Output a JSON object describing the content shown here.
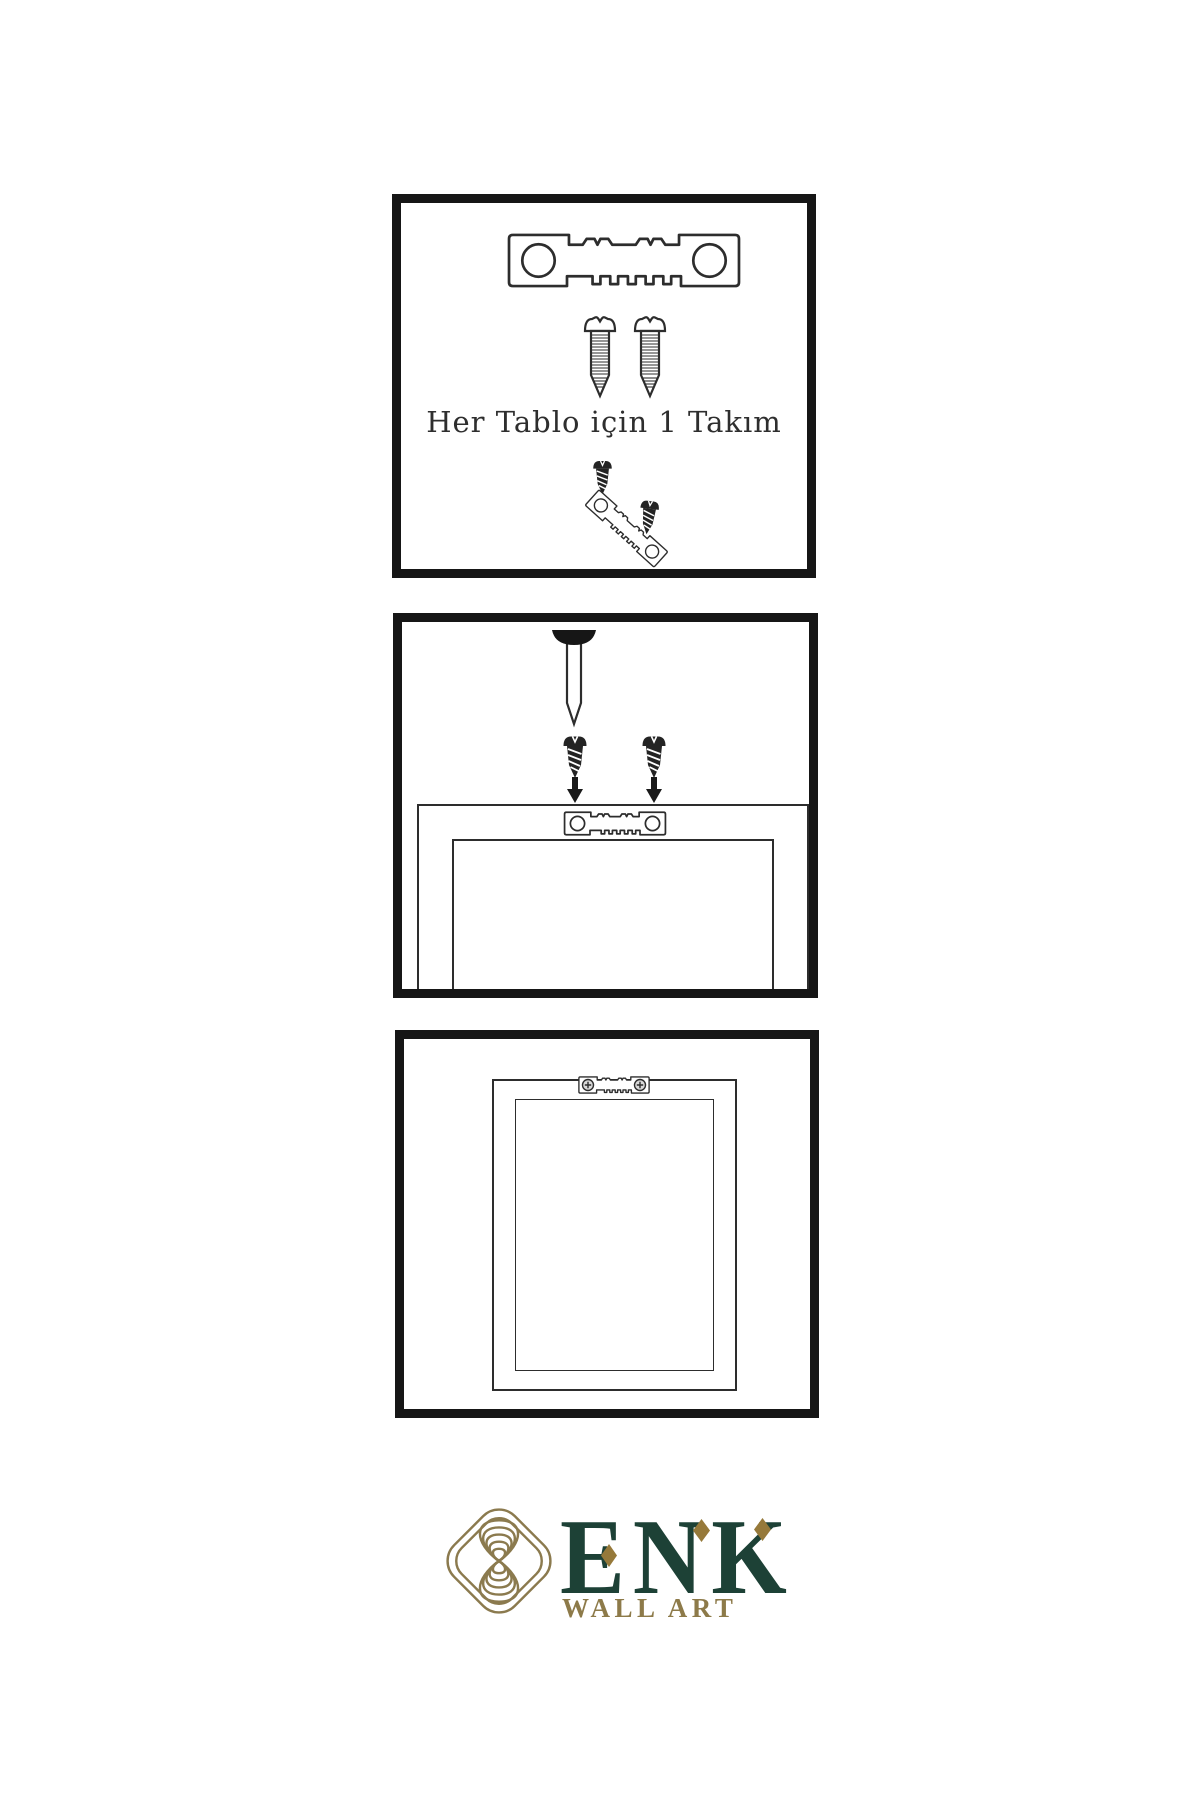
{
  "image": {
    "kind": "wall-art-hanging-instructions-infographic",
    "background": "#ffffff"
  },
  "colors": {
    "panel_border": "#161616",
    "line_art": "#2d2d2d",
    "dark_fill": "#242424",
    "brand_green": "#1d4136",
    "brand_gold": "#8d7a49",
    "diamond_gold": "#96793a",
    "icon_gold": "#8b7a4e"
  },
  "panels": [
    {
      "name": "hardware-kit",
      "caption": "Her Tablo için 1 Takım",
      "items": [
        "sawtooth-hanger-icon",
        "screw-icon",
        "screw-icon",
        "screw-icon",
        "screw-icon",
        "tilted-sawtooth-hanger-icon"
      ]
    },
    {
      "name": "mounting-step",
      "items": [
        "nail-icon",
        "screw-icon",
        "screw-icon",
        "arrow-down-icon",
        "arrow-down-icon",
        "sawtooth-hanger-icon",
        "frame-back-view"
      ]
    },
    {
      "name": "hanging-step",
      "items": [
        "sawtooth-hanger-icon",
        "phillips-screw-icon",
        "phillips-screw-icon",
        "frame-back-view"
      ]
    }
  ],
  "logo": {
    "icon": "knot-icon",
    "brand": "ENK",
    "tagline": "WALL ART"
  }
}
